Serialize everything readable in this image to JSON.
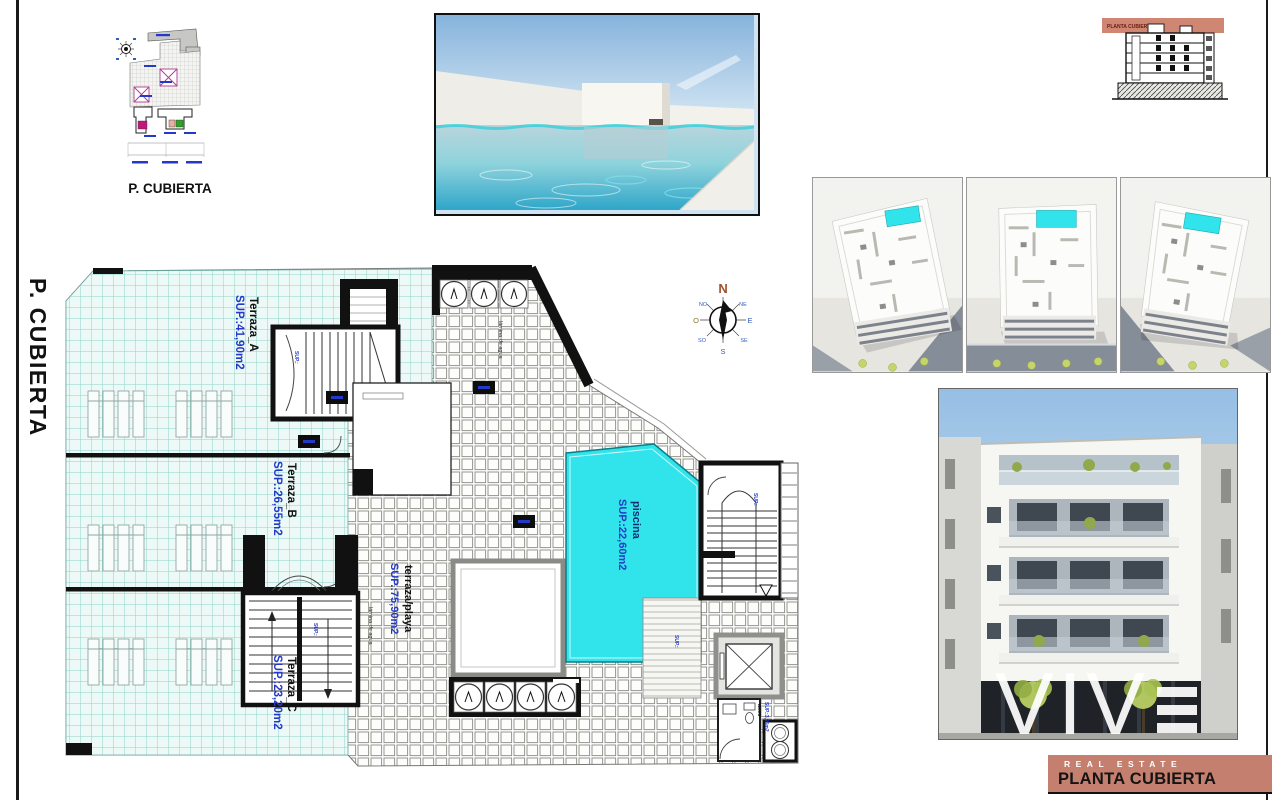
{
  "sheet": {
    "side_title": "P. CUBIERTA"
  },
  "site_plan": {
    "caption": "P. CUBIERTA"
  },
  "section_drawing": {
    "band_label": "PLANTA CUBIERTA"
  },
  "compass": {
    "n": "N",
    "ne": "NE",
    "e": "E",
    "se": "SE",
    "s": "S",
    "so": "SO",
    "o": "O",
    "no": "NO"
  },
  "floor_plan": {
    "terraza_a": {
      "name": "Terraza_A",
      "area": "SUP.:41,90m2"
    },
    "terraza_b": {
      "name": "Terraza_B",
      "area": "SUP.:26,55m2"
    },
    "terraza_c": {
      "name": "Terraza_C",
      "area": "SUP.:23,20m2"
    },
    "terraza_playa": {
      "name": "terraza/playa",
      "area": "SUP.:75,90m2"
    },
    "piscina": {
      "name": "piscina",
      "area": "SUP.:22,60m2"
    },
    "aseo": {
      "name": "aseo",
      "area": "SUP.:3,95m2"
    },
    "micro_label": "SUP.:",
    "deck_note": "lámina de agua"
  },
  "title_block": {
    "brand": "VIV",
    "brand_tagline": "REAL ESTATE",
    "sheet_name": "PLANTA CUBIERTA"
  },
  "colors": {
    "banner": "#c57f6e",
    "pool": "#31e3eb",
    "pooledge": "#0a7d85",
    "blue": "#2339c9",
    "band": "#cf8672"
  }
}
